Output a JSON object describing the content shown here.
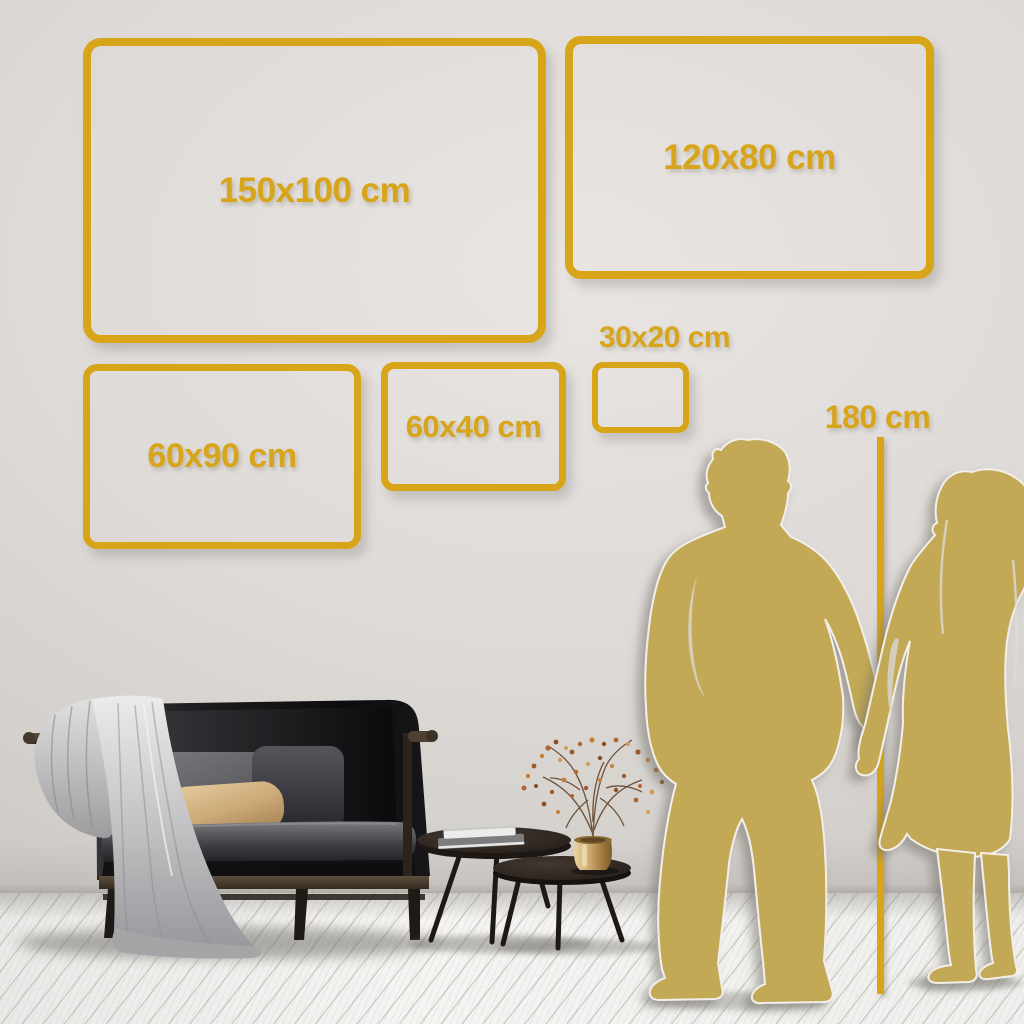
{
  "colors": {
    "accent_gold": "#D7A41A",
    "silhouette_gold": "#C3A854",
    "wall": "#DCD8D4",
    "floor": "#F2F1EF"
  },
  "size_frames": [
    {
      "id": "150x100",
      "label": "150x100 cm"
    },
    {
      "id": "120x80",
      "label": "120x80 cm"
    },
    {
      "id": "60x90",
      "label": "60x90 cm"
    },
    {
      "id": "60x40",
      "label": "60x40 cm"
    },
    {
      "id": "30x20",
      "label": "30x20 cm"
    }
  ],
  "height_marker": {
    "label": "180 cm"
  },
  "scene": {
    "illustrations": [
      "sofa-with-throw-blanket",
      "nesting-coffee-tables",
      "brass-vase-with-dried-branches",
      "man-silhouette",
      "woman-silhouette"
    ]
  }
}
